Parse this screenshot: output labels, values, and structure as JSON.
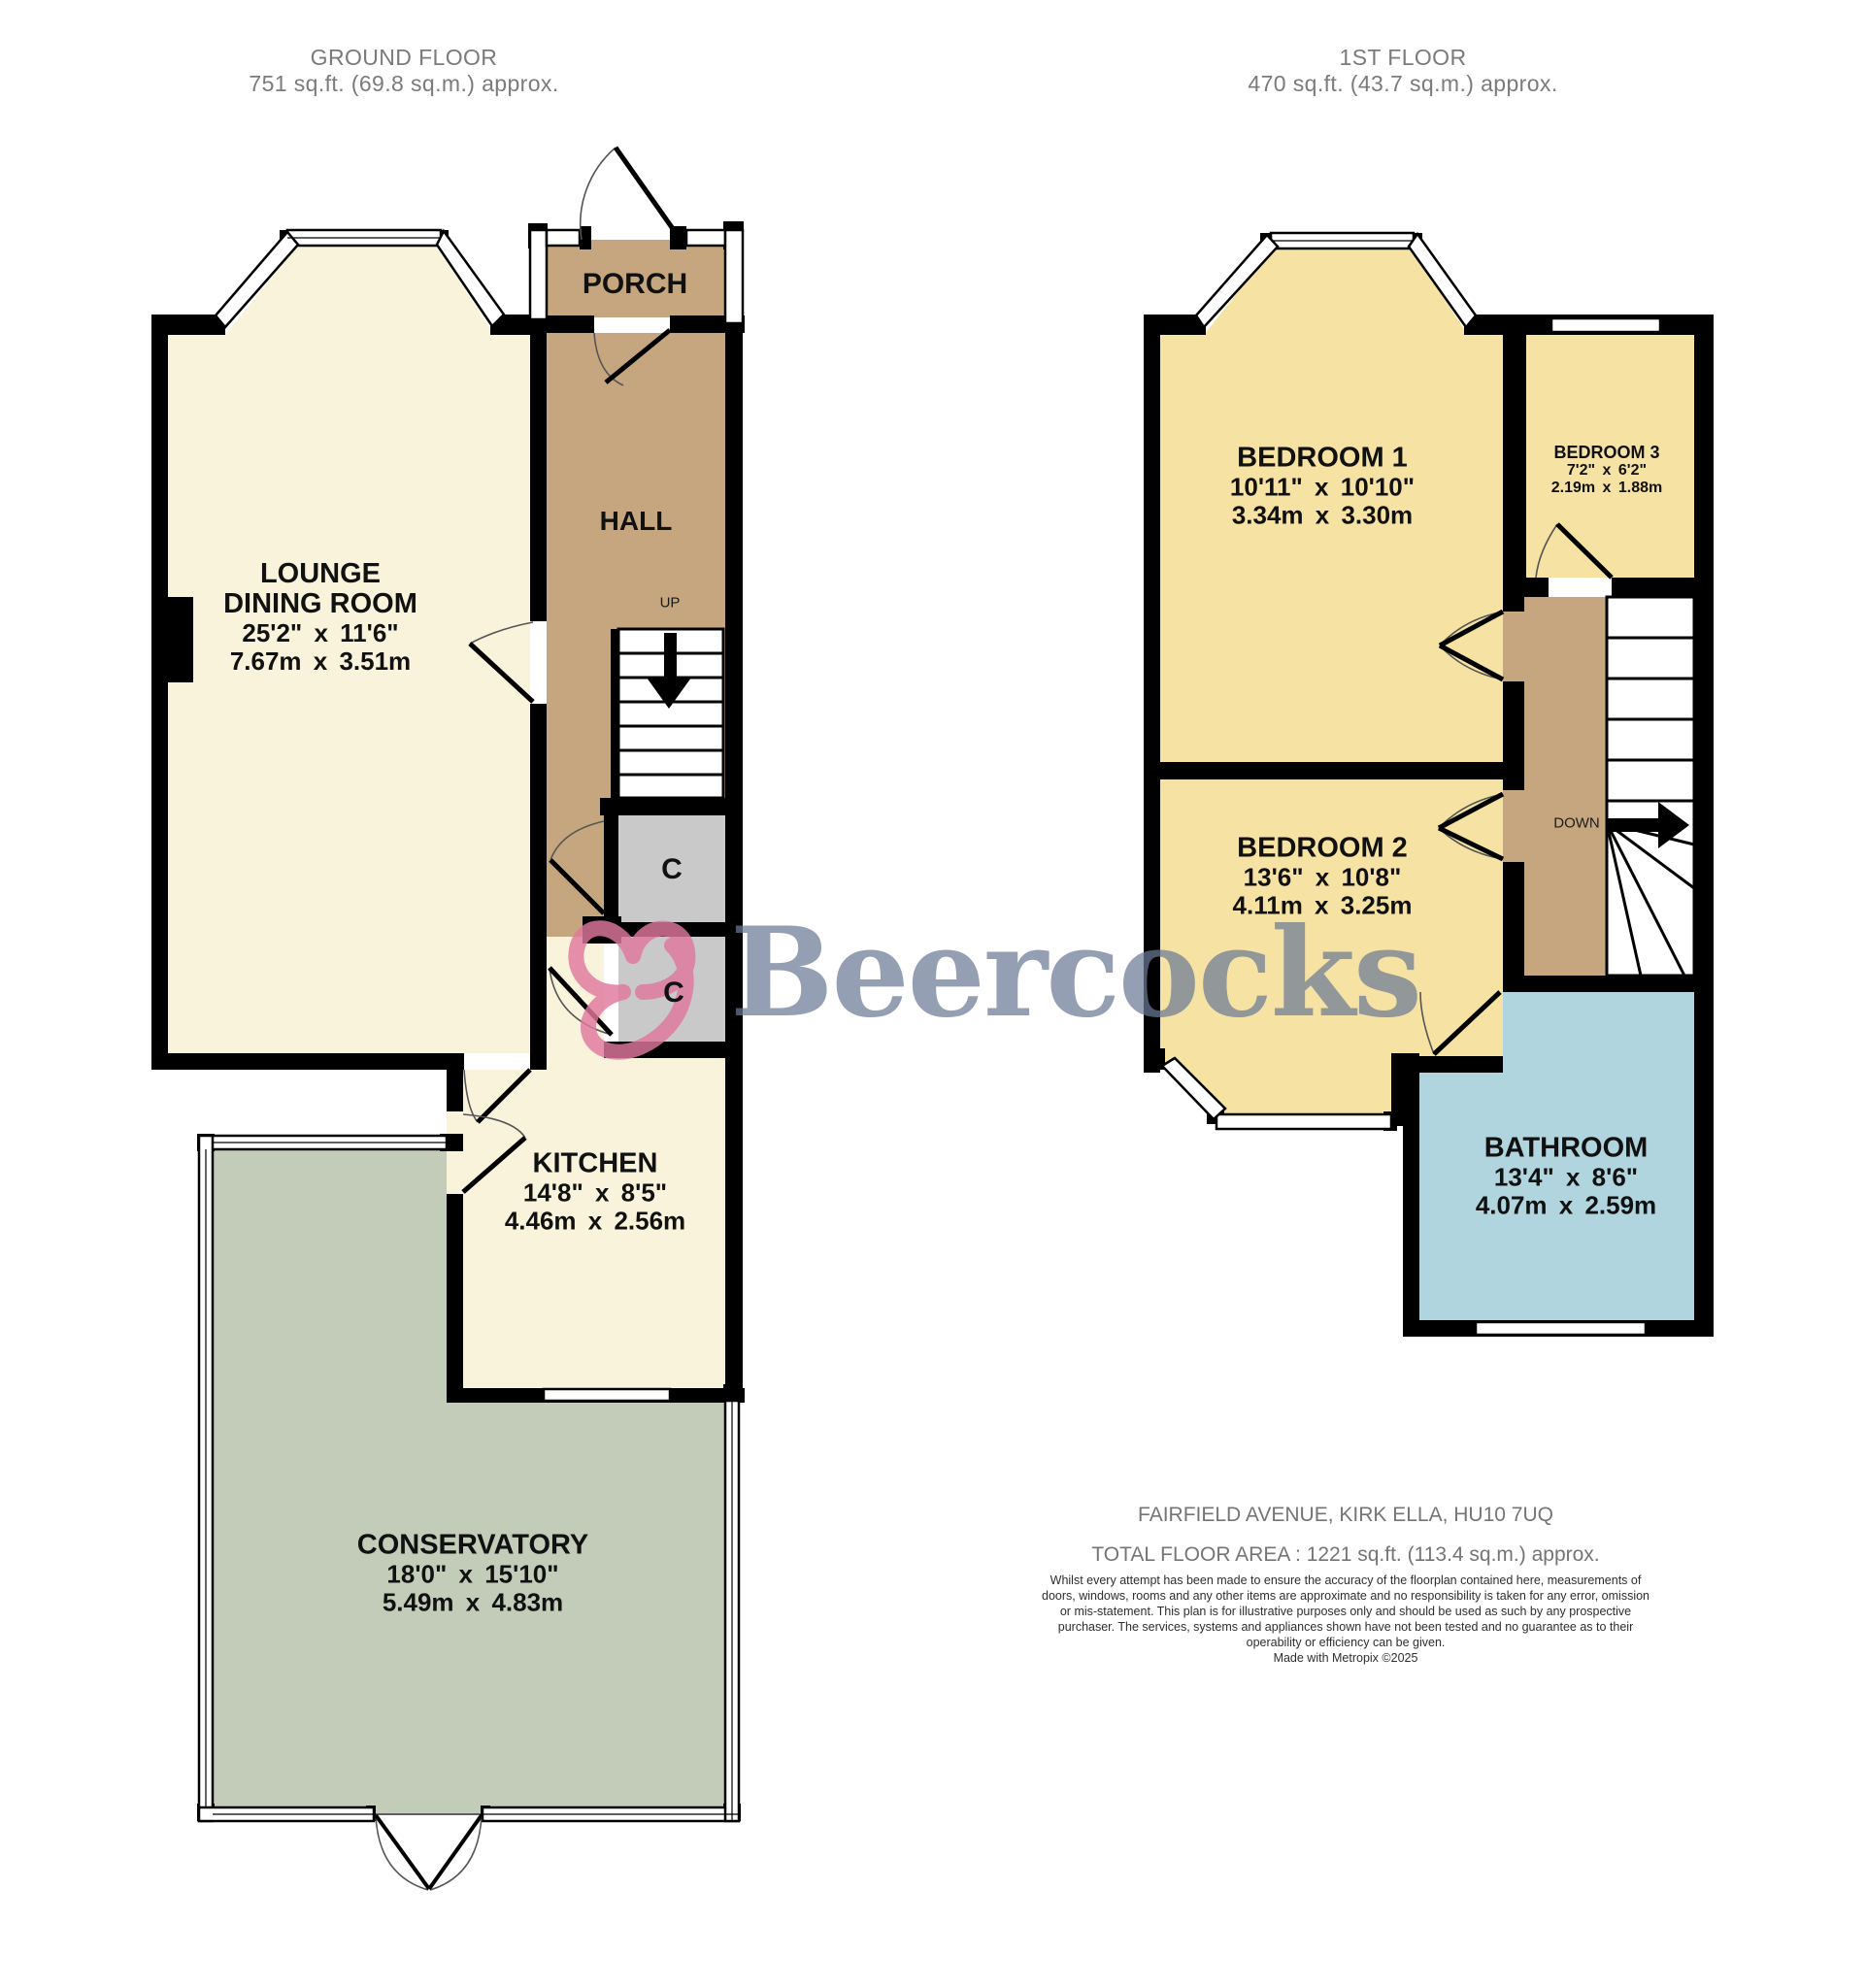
{
  "headers": {
    "ground": {
      "title": "GROUND FLOOR",
      "area": "751 sq.ft. (69.8 sq.m.) approx."
    },
    "first": {
      "title": "1ST FLOOR",
      "area": "470 sq.ft. (43.7 sq.m.) approx."
    }
  },
  "ground_floor": {
    "lounge": {
      "name1": "LOUNGE",
      "name2": "DINING ROOM",
      "imperial": "25'2\" x 11'6\"",
      "metric": "7.67m x 3.51m"
    },
    "porch": {
      "name": "PORCH"
    },
    "hall": {
      "name": "HALL"
    },
    "kitchen": {
      "name": "KITCHEN",
      "imperial": "14'8\" x 8'5\"",
      "metric": "4.46m x 2.56m"
    },
    "conservatory": {
      "name": "CONSERVATORY",
      "imperial": "18'0\" x 15'10\"",
      "metric": "5.49m x 4.83m"
    },
    "closet_top": {
      "label": "C"
    },
    "closet_bottom": {
      "label": "C"
    },
    "stairs": {
      "label": "UP"
    }
  },
  "first_floor": {
    "bedroom1": {
      "name": "BEDROOM 1",
      "imperial": "10'11\" x 10'10\"",
      "metric": "3.34m x 3.30m"
    },
    "bedroom2": {
      "name": "BEDROOM 2",
      "imperial": "13'6\" x 10'8\"",
      "metric": "4.11m x 3.25m"
    },
    "bedroom3": {
      "name": "BEDROOM 3",
      "imperial": "7'2\" x 6'2\"",
      "metric": "2.19m x 1.88m"
    },
    "bathroom": {
      "name": "BATHROOM",
      "imperial": "13'4\" x 8'6\"",
      "metric": "4.07m x 2.59m"
    },
    "stairs": {
      "label": "DOWN"
    }
  },
  "watermark": {
    "text": "Beercocks"
  },
  "footer": {
    "address": "FAIRFIELD AVENUE, KIRK ELLA, HU10 7UQ",
    "total_area": "TOTAL FLOOR AREA : 1221 sq.ft. (113.4 sq.m.) approx.",
    "disclaimer": "Whilst every attempt has been made to ensure the accuracy of the floorplan contained here, measurements of doors, windows, rooms and any other items are approximate and no responsibility is taken for any error, omission or mis-statement. This plan is for illustrative purposes only and should be used as such by any prospective purchaser. The services, systems and appliances shown have not been tested and no guarantee as to their operability or efficiency can be given.",
    "credit": "Made with Metropix ©2025"
  },
  "colors": {
    "wall": "#000000",
    "room_cream": "#faf3dc",
    "hall_tan": "#c6a67e",
    "conservatory_sage": "#c3ccb9",
    "bedroom_yellow": "#f6e3a3",
    "bathroom_blue": "#b0d5de",
    "closet_grey": "#c9c9c9",
    "watermark_text": "#6d7b97",
    "watermark_pink": "#e0779f",
    "header_grey": "#7b7b7b"
  }
}
